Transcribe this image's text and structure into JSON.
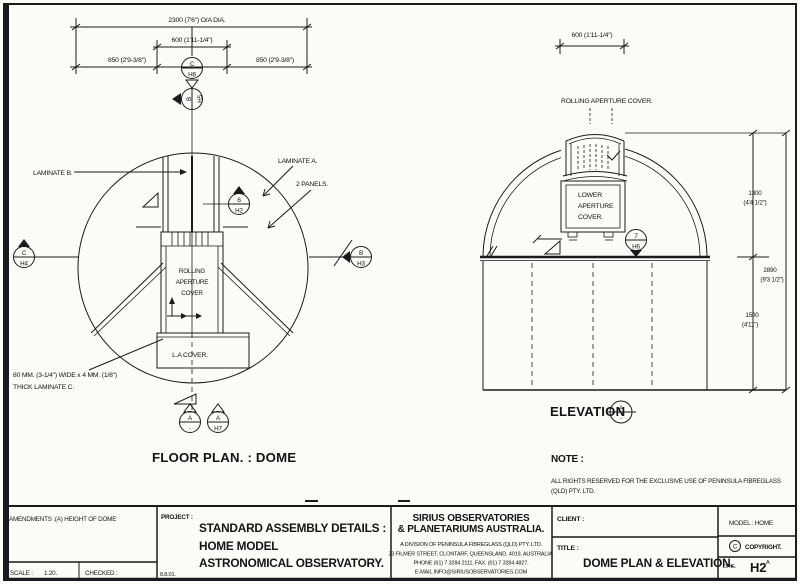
{
  "plan": {
    "dim_overall": "2300 (7'6\") O/A DIA.",
    "dim_aperture": "600 (1'11-1/4\")",
    "dim_850_left": "850 (2'9-3/8\")",
    "dim_850_right": "850 (2'9-3/8\")",
    "label_laminate_b": "LAMINATE B.",
    "label_laminate_a": "LAMINATE A.",
    "label_2_panels": "2 PANELS.",
    "rolling_cover": [
      "ROLLING",
      "APERTURE",
      "COVER"
    ],
    "la_cover": "L.A COVER.",
    "laminate_c_1": "80 MM. (3-1/4\") WIDE x 4 MM. (1/8\")",
    "laminate_c_2": "THICK LAMINATE C.",
    "caption": "FLOOR PLAN. : DOME",
    "markers": {
      "c_h6": {
        "top": "C",
        "bottom": "H6"
      },
      "b_h5": {
        "top": "B",
        "bottom": "H5"
      },
      "c_h4": {
        "top": "C",
        "bottom": "H4"
      },
      "b_h3": {
        "top": "B",
        "bottom": "H3"
      },
      "n6_h2": {
        "top": "6",
        "bottom": "H2"
      },
      "a_dash": {
        "top": "A",
        "bottom": "-"
      },
      "a_h7": {
        "top": "A",
        "bottom": "H7"
      }
    }
  },
  "elevation": {
    "dim_aperture": "600 (1'11-1/4\")",
    "label_rolling_cover": "ROLLING APERTURE COVER.",
    "lower_cover": [
      "LOWER",
      "APERTURE",
      "COVER."
    ],
    "dim_dome_mm": "1300",
    "dim_dome_ft": "(4'4 1/2\")",
    "dim_total_mm": "2890",
    "dim_total_ft": "(9'3 1/2\")",
    "dim_wall_mm": "1500",
    "dim_wall_ft": "(4'11\")",
    "caption": "ELEVATION",
    "marker_a": {
      "top": "A",
      "bottom": "-"
    },
    "marker_7_h6": {
      "top": "7",
      "bottom": "H6"
    },
    "note_label": "NOTE :",
    "note_1": "ALL RIGHTS RESERVED FOR THE EXCLUSIVE USE OF PENINSULA FIBREGLASS",
    "note_2": "(QLD) PTY. LTD."
  },
  "titleblock": {
    "amendments": "AMENDMENTS :(A) HEIGHT OF DOME",
    "scale_label": "SCALE :",
    "scale_value": "1:20.",
    "checked_label": "CHECKED :",
    "project_label": "PROJECT :",
    "project_1": "STANDARD ASSEMBLY DETAILS :",
    "project_2": "HOME MODEL",
    "project_3": "ASTRONOMICAL OBSERVATORY.",
    "date": "8.8.01.",
    "company_1": "SIRIUS OBSERVATORIES",
    "company_2": "& PLANETARIUMS AUSTRALIA.",
    "company_3": "A DIVISION OF PENINSULA FIBREGLASS (QLD) PTY. LTD.",
    "company_4": "33 FILMER STREET, CLONTARF, QUEENSLAND, 4019, AUSTRALIA.",
    "company_5": "PHONE (61) 7 3284 2111.  FAX. (61) 7 3284 4827.",
    "company_6": "E-MAIL INFO@SIRIUSOBSERVATORIES.COM",
    "client_label": "CLIENT :",
    "title_label": "TITLE :",
    "title_value": "DOME PLAN & ELEVATION.",
    "model": "MODEL : HOME",
    "copyright_c": "C",
    "copyright": "COPYRIGHT.",
    "drg_label": "DRG.",
    "drg_value": "H2",
    "drg_rev": "A"
  }
}
